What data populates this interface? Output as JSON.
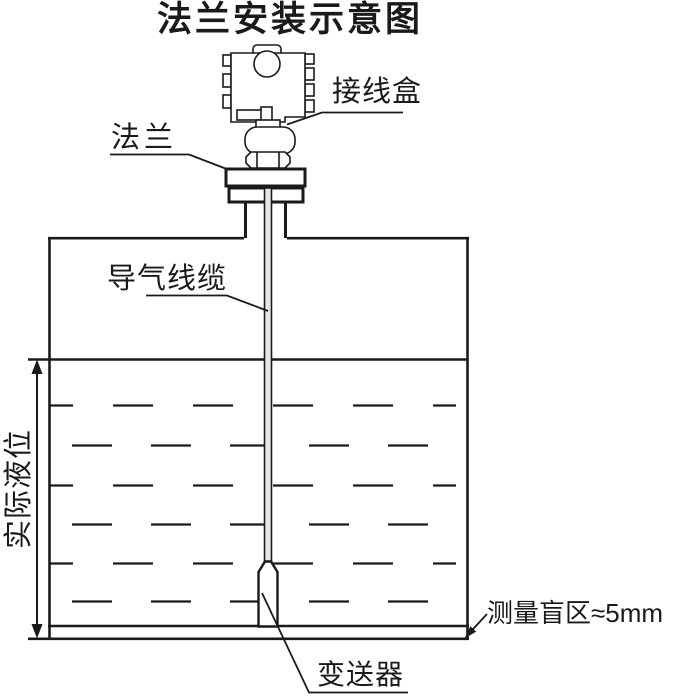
{
  "title": "法兰安装示意图",
  "labels": {
    "junction_box": "接线盒",
    "flange": "法兰",
    "air_cable": "导气线缆",
    "actual_level": "实际液位",
    "transmitter": "变送器",
    "blind_zone": "测量盲区≈5mm"
  },
  "colors": {
    "line": "#1a1a1a",
    "background": "#ffffff",
    "cable_fill": "#e6e6e6"
  }
}
